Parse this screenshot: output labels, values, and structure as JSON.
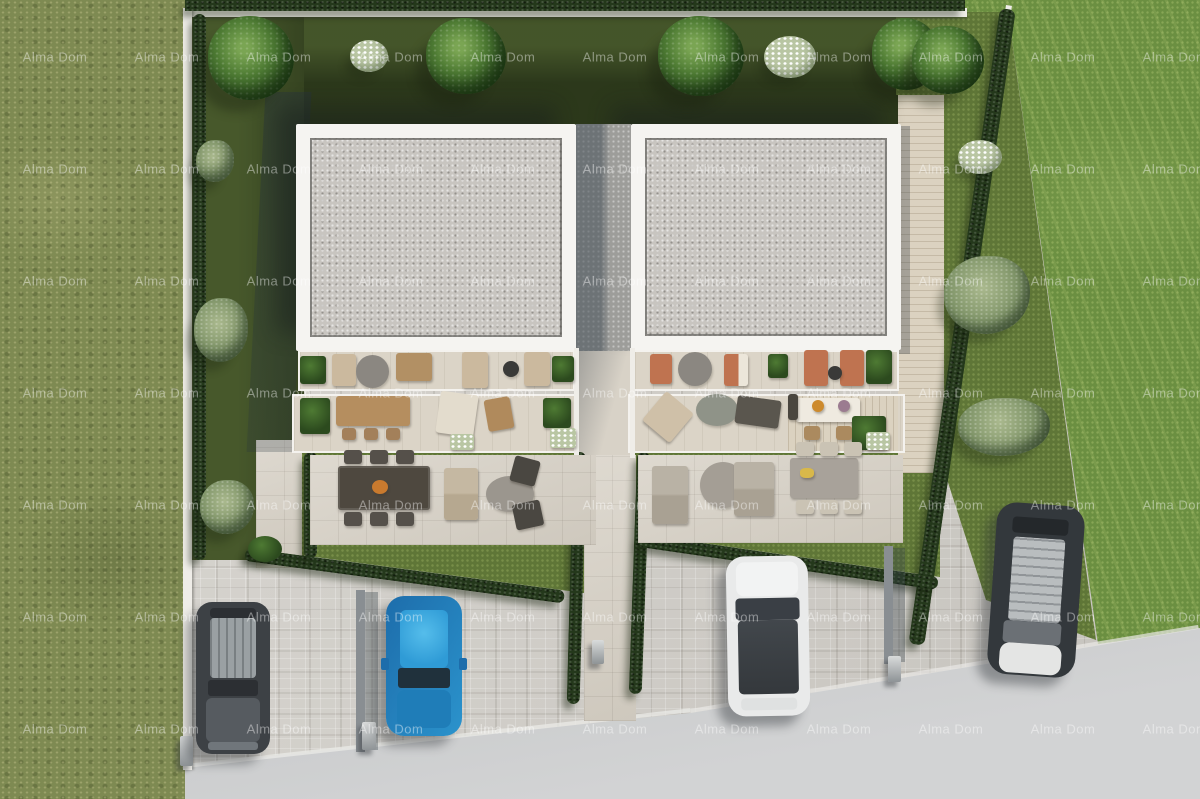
{
  "watermark": {
    "text": "Alma Dom",
    "rows": 7,
    "cols": 11,
    "origin_x": 55,
    "origin_y": 57,
    "step_x": 112,
    "step_y": 112,
    "color": "rgba(255,255,255,0.42)"
  },
  "palette": {
    "grass-left": "#7e8a52",
    "grass-right": "#6b8f41",
    "lawn-top": "#47582b",
    "lawn-light": "#5f7637",
    "hedge": "#24381b",
    "wall-white": "#efede8",
    "building-white": "#f5f4f1",
    "roof-gravel": "#c8c5c0",
    "paving-stone": "#d8d2c7",
    "cobble": "#d0cdc7",
    "road": "#c3c5c6",
    "deck-wood": "#dbd2c0",
    "car-dark": "#3d4145",
    "car-blue": "#2b93cc",
    "car-white": "#e9eaea",
    "car-black": "#33383c",
    "terracotta": "#bf7350",
    "wood": "#b28e60",
    "cream": "#e3dccd",
    "watermark": "rgba(255,255,255,0.42)"
  },
  "scene": {
    "houses": 2,
    "parked_cars": 4
  }
}
